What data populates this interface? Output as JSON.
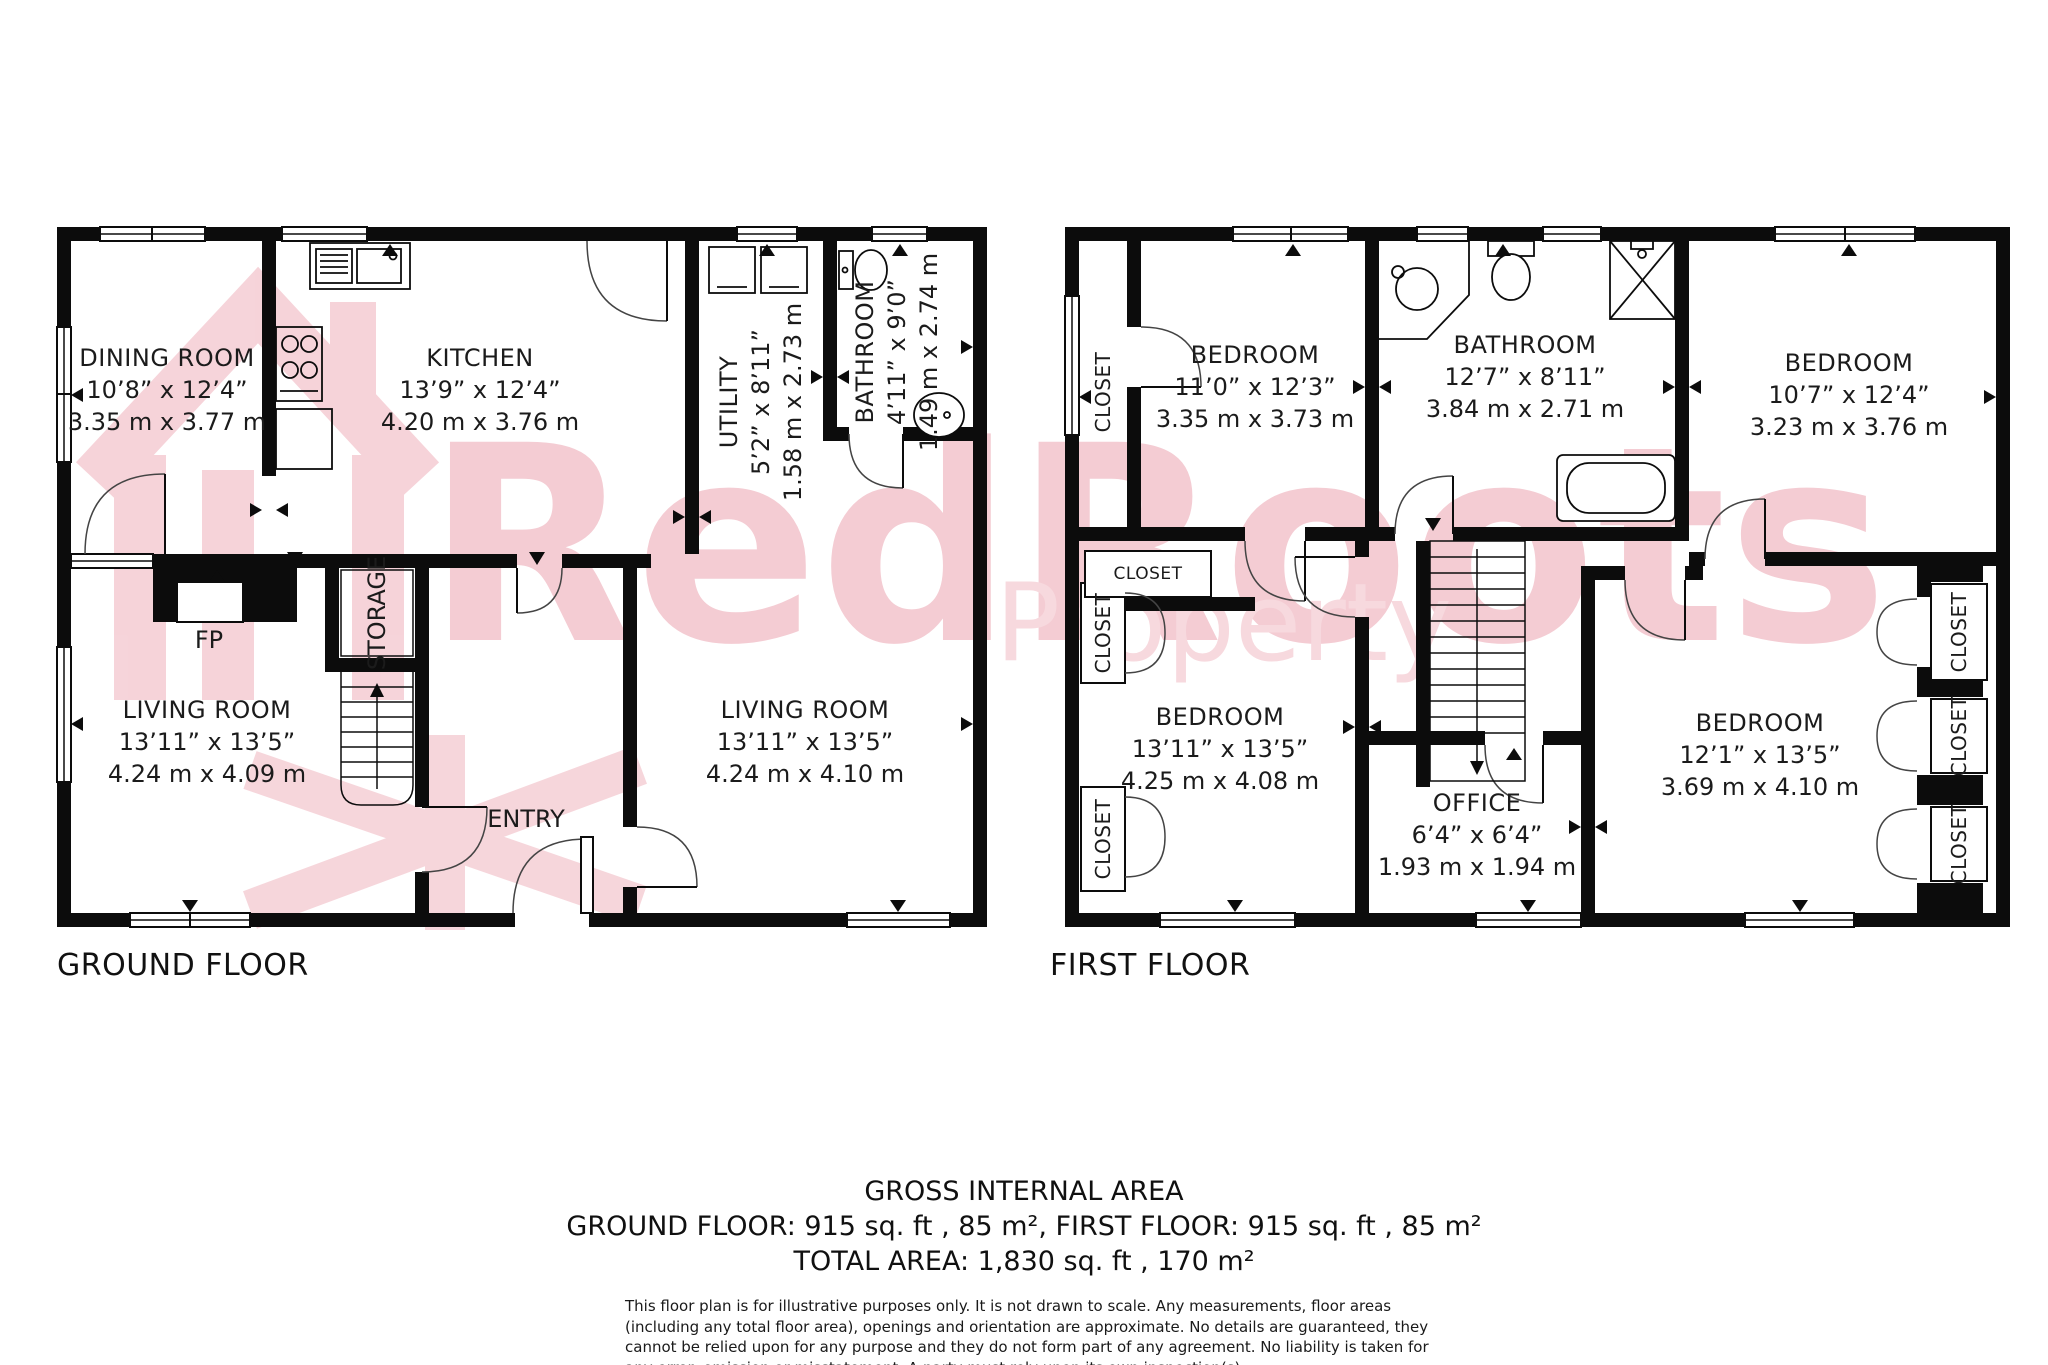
{
  "watermark": {
    "line1": "RedRoots",
    "line2": "Property"
  },
  "ground": {
    "label": "GROUND FLOOR",
    "dining": {
      "name": "DINING ROOM",
      "ft": "10’8” x 12’4”",
      "m": "3.35 m x 3.77 m"
    },
    "kitchen": {
      "name": "KITCHEN",
      "ft": "13’9” x 12’4”",
      "m": "4.20 m x 3.76 m"
    },
    "utility": {
      "name": "UTILITY",
      "ft": "5’2” x 8’11”",
      "m": "1.58 m x 2.73 m"
    },
    "bathroom": {
      "name": "BATHROOM",
      "ft": "4’11” x 9’0”",
      "m": "1.49 m x 2.74 m"
    },
    "living_left": {
      "name": "LIVING ROOM",
      "ft": "13’11” x 13’5”",
      "m": "4.24 m x 4.09 m"
    },
    "living_right": {
      "name": "LIVING ROOM",
      "ft": "13’11” x 13’5”",
      "m": "4.24 m x 4.10 m"
    },
    "storage": "STORAGE",
    "entry": "ENTRY",
    "fp": "FP"
  },
  "first": {
    "label": "FIRST FLOOR",
    "bedroom_tl": {
      "name": "BEDROOM",
      "ft": "11’0” x 12’3”",
      "m": "3.35 m x 3.73 m"
    },
    "bathroom": {
      "name": "BATHROOM",
      "ft": "12’7” x 8’11”",
      "m": "3.84 m x 2.71 m"
    },
    "bedroom_tr": {
      "name": "BEDROOM",
      "ft": "10’7” x 12’4”",
      "m": "3.23 m x 3.76 m"
    },
    "bedroom_bl": {
      "name": "BEDROOM",
      "ft": "13’11” x 13’5”",
      "m": "4.25 m x 4.08 m"
    },
    "office": {
      "name": "OFFICE",
      "ft": "6’4” x 6’4”",
      "m": "1.93 m x 1.94 m"
    },
    "bedroom_br": {
      "name": "BEDROOM",
      "ft": "12’1” x 13’5”",
      "m": "3.69 m x 4.10 m"
    },
    "closet": "CLOSET"
  },
  "summary": {
    "title": "GROSS INTERNAL AREA",
    "floors_line": "GROUND FLOOR: 915 sq. ft , 85 m², FIRST FLOOR: 915 sq. ft , 85 m²",
    "total_line": "TOTAL AREA: 1,830 sq. ft , 170 m²"
  },
  "disclaimer": "This floor plan is for illustrative purposes only. It is not drawn to scale. Any measurements, floor areas (including any total floor area), openings and orientation are approximate. No details are guaranteed, they cannot be relied upon for any purpose and they do not form part of any agreement. No liability is taken for any error, omission or misstatement. A party must rely upon its own inspection(s)."
}
